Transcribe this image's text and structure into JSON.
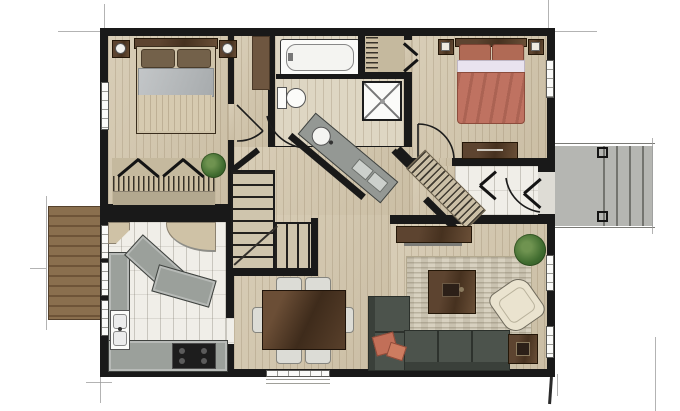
{
  "meta": {
    "type": "architectural-floor-plan",
    "rendering": "hand-rendered watercolor top view, no text labels",
    "storeys_shown": 1
  },
  "palette": {
    "background": "#ffffff",
    "walls": "#191919",
    "wood_floor": "#d4c8af",
    "bath_floor": "#ded6c3",
    "kitchen_tile": "#f0eee8",
    "deck_wood": "#8a6f4e",
    "deck_concrete": "#b5b6b2",
    "counter_grey": "#9ba09b",
    "dark_wood_furniture": "#5d4430",
    "sofa_green_grey": "#4c534c",
    "coral_bedding": "#bf7261",
    "grey_blanket": "#b9bcbe",
    "cream_armchair": "#eae3cf",
    "plant_green": "#3f6b2f",
    "rug_beige": "#d8d1c0"
  },
  "rooms": [
    {
      "id": "bedroom-1",
      "position": "top-left",
      "furniture": [
        "double-bed",
        "nightstand-left",
        "nightstand-right",
        "table-lamp-left",
        "table-lamp-right",
        "bifold-closet",
        "hanging-clothes",
        "potted-plant"
      ],
      "openings": [
        "window-left-wall",
        "door-to-hallway"
      ]
    },
    {
      "id": "bathroom",
      "position": "top-center",
      "furniture": [
        "bathtub",
        "toilet",
        "corner-shower",
        "diagonal-vanity-with-round-sink"
      ],
      "openings": [
        "diagonal-door-to-hallway"
      ]
    },
    {
      "id": "laundry-closet",
      "position": "top-center-right",
      "furniture": [
        "hanging-clothes"
      ],
      "openings": [
        "bifold-door-to-bedroom-2"
      ]
    },
    {
      "id": "bedroom-2",
      "position": "top-right",
      "furniture": [
        "double-bed-coral",
        "nightstand-left",
        "nightstand-right",
        "dresser-at-foot",
        "diagonal-walk-in-closet"
      ],
      "openings": [
        "window-right-wall",
        "door-to-landing"
      ]
    },
    {
      "id": "hallway",
      "position": "center",
      "furniture": [
        "tall-brown-cabinet",
        "l-shaped-staircase"
      ]
    },
    {
      "id": "landing",
      "position": "center-right",
      "furniture": [],
      "openings": [
        "door-to-right-deck"
      ]
    },
    {
      "id": "kitchen",
      "position": "bottom-left",
      "furniture": [
        "l-shaped-counter",
        "double-sink",
        "range-stove",
        "angled-island",
        "corner-pantry",
        "corner-cabinet"
      ],
      "openings": [
        "deck-door-left-wall",
        "window-left-wall-1",
        "window-left-wall-2",
        "pass-to-dining"
      ]
    },
    {
      "id": "dining-room",
      "position": "bottom-center",
      "furniture": [
        "rectangular-dining-table",
        "chair-1",
        "chair-2",
        "chair-3",
        "chair-4",
        "chair-5",
        "chair-6"
      ],
      "openings": [
        "window-bottom-wall"
      ]
    },
    {
      "id": "living-room",
      "position": "bottom-right",
      "furniture": [
        "sectional-sofa",
        "coral-throw-pillows",
        "area-rug",
        "coffee-table",
        "cream-armchair",
        "side-table",
        "media-console",
        "potted-plant"
      ],
      "openings": [
        "window-right-wall-1",
        "window-right-wall-2"
      ]
    },
    {
      "id": "deck-left",
      "position": "left-exterior",
      "furniture": [
        "wood-plank-decking"
      ]
    },
    {
      "id": "deck-right",
      "position": "right-exterior",
      "furniture": [
        "concrete-landing",
        "exterior-steps",
        "post-top",
        "post-bottom"
      ]
    }
  ],
  "counts": {
    "windows": 7,
    "interior_doors": 4,
    "exterior_doors": 2,
    "closets": 4,
    "staircases": 1
  }
}
